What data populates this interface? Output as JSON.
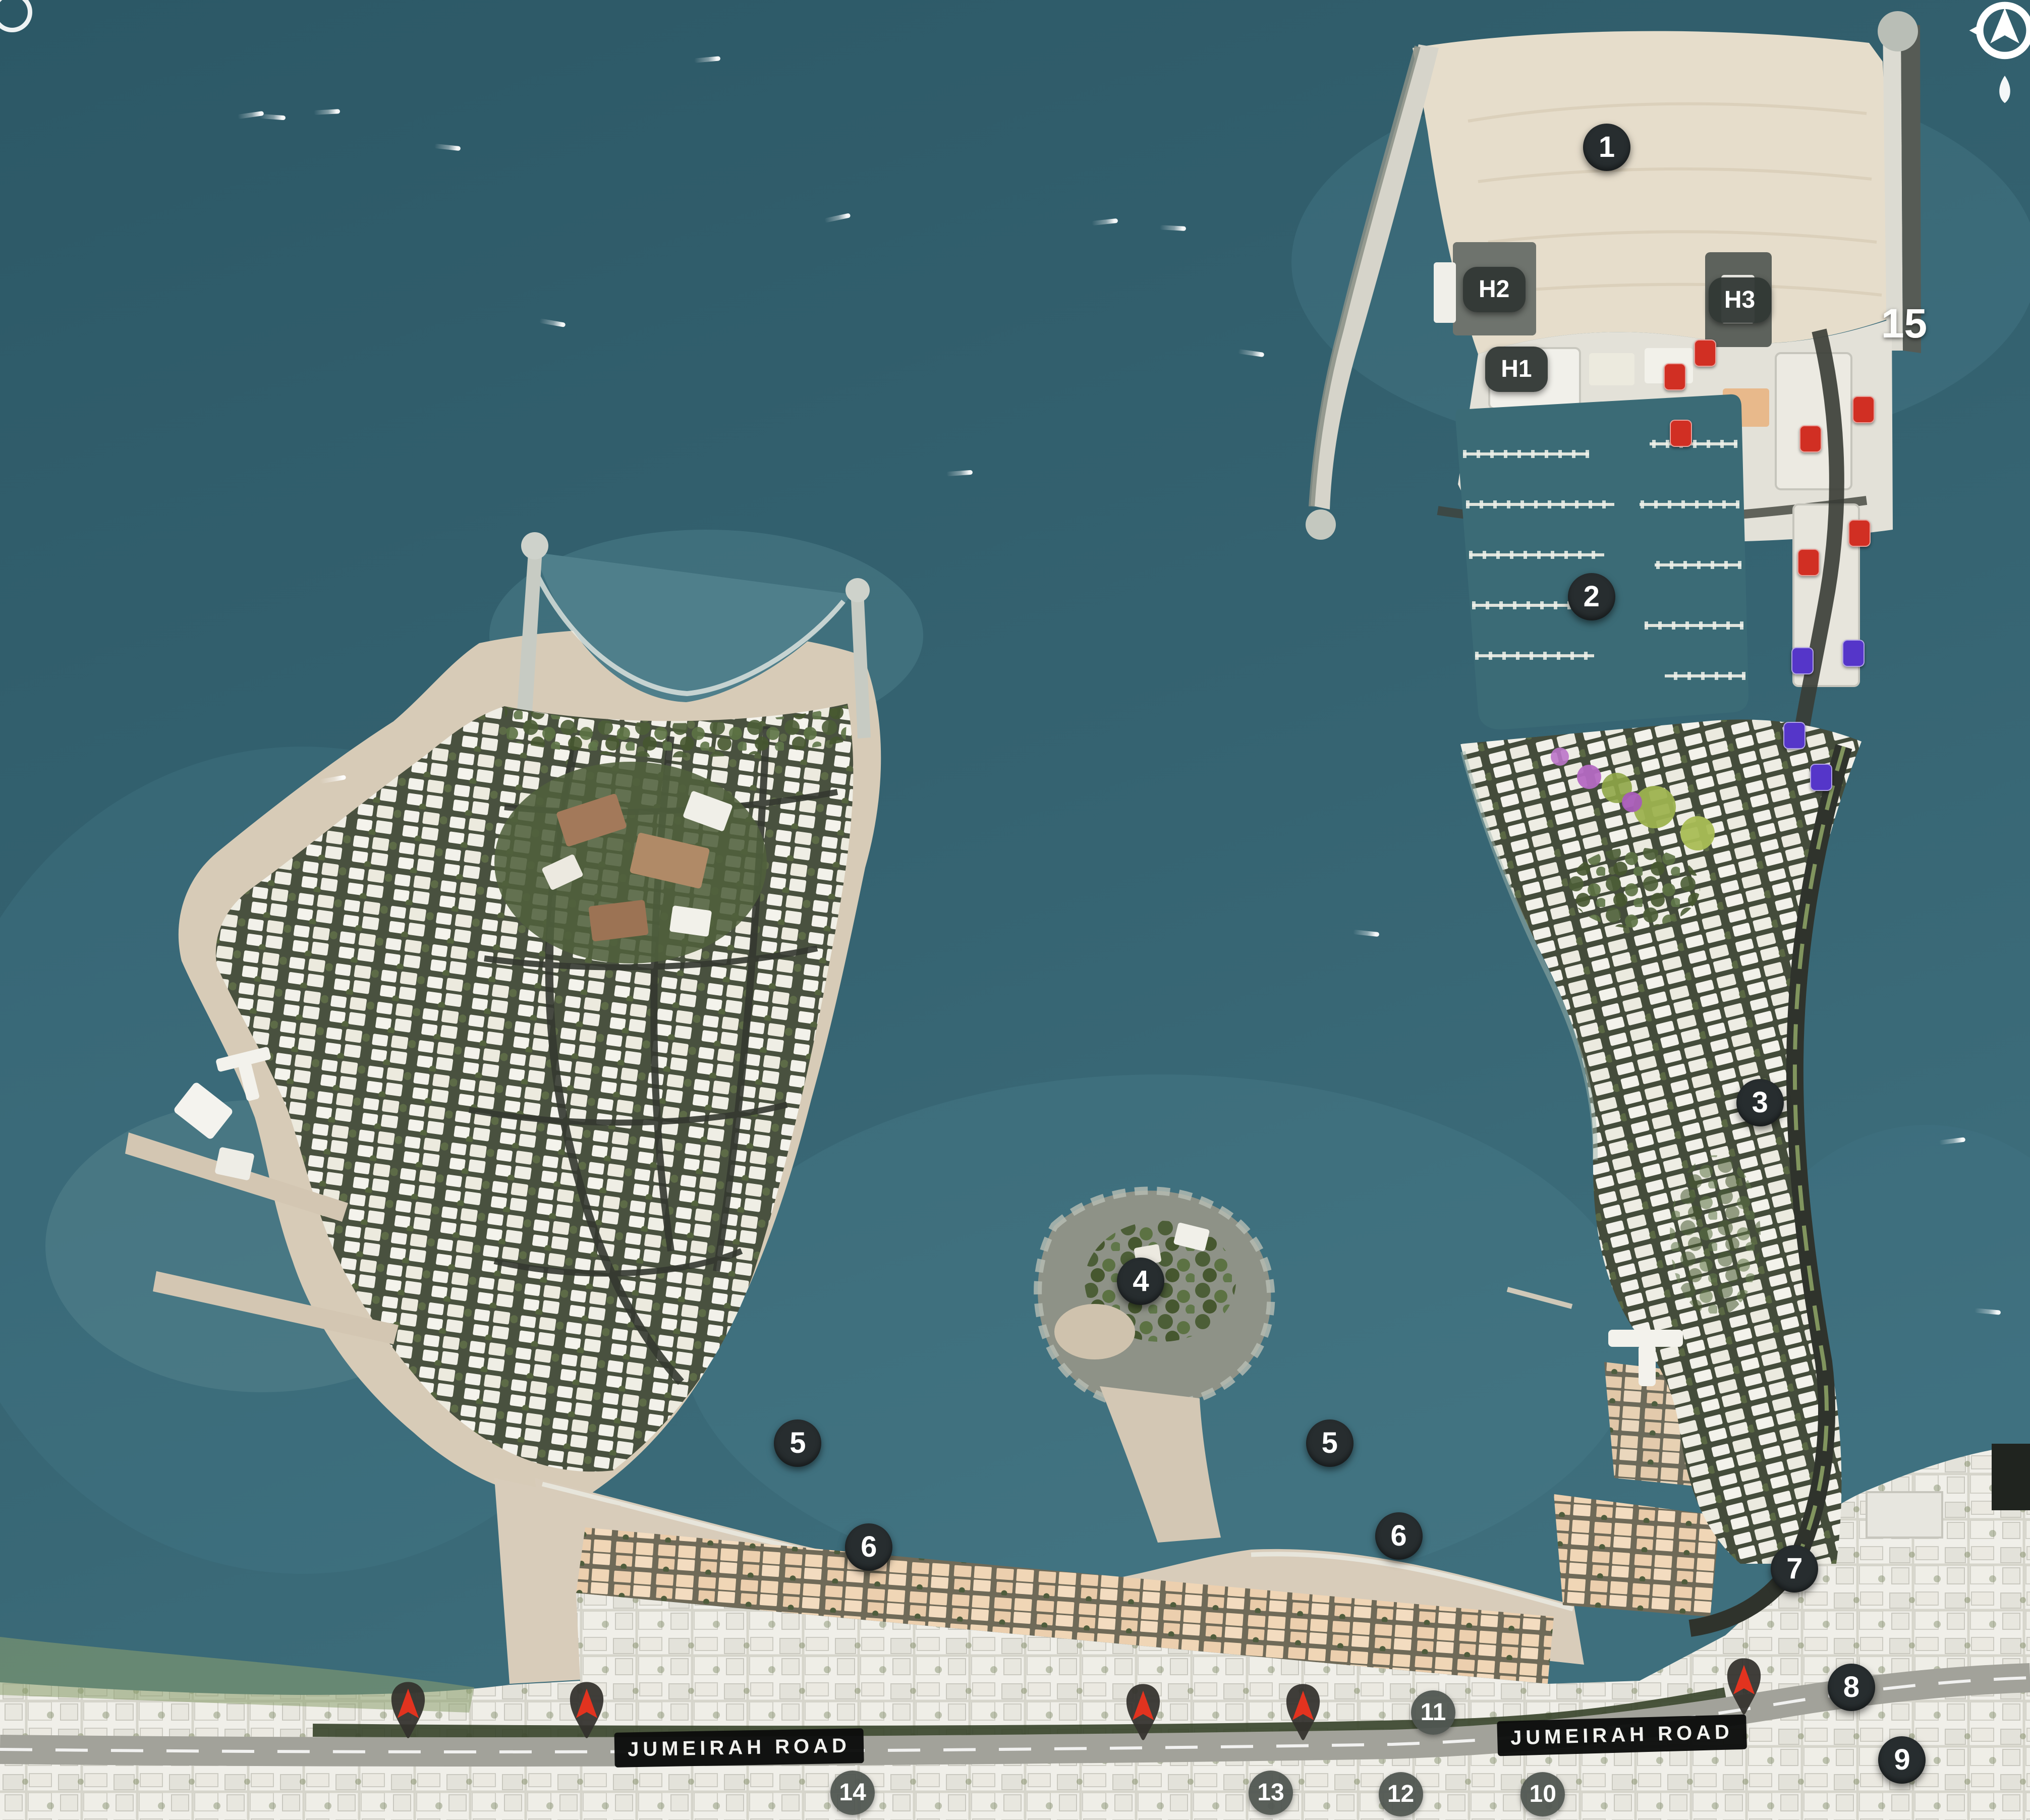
{
  "map": {
    "road_labels": [
      {
        "text": "JUMEIRAH ROAD",
        "position": "left"
      },
      {
        "text": "JUMEIRAH ROAD",
        "position": "right"
      }
    ],
    "markers": [
      {
        "label": "1",
        "x_pct": 79.15,
        "y_pct": 8.1,
        "variant": "dark"
      },
      {
        "label": "2",
        "x_pct": 78.4,
        "y_pct": 32.8,
        "variant": "dark"
      },
      {
        "label": "3",
        "x_pct": 86.7,
        "y_pct": 60.6,
        "variant": "dark"
      },
      {
        "label": "4",
        "x_pct": 56.2,
        "y_pct": 70.4,
        "variant": "dark"
      },
      {
        "label": "5",
        "x_pct": 39.3,
        "y_pct": 79.3,
        "variant": "dark"
      },
      {
        "label": "5",
        "x_pct": 65.5,
        "y_pct": 79.3,
        "variant": "dark"
      },
      {
        "label": "6",
        "x_pct": 42.8,
        "y_pct": 85.0,
        "variant": "dark"
      },
      {
        "label": "6",
        "x_pct": 68.9,
        "y_pct": 84.4,
        "variant": "dark"
      },
      {
        "label": "7",
        "x_pct": 88.4,
        "y_pct": 86.2,
        "variant": "dark"
      },
      {
        "label": "8",
        "x_pct": 91.2,
        "y_pct": 92.7,
        "variant": "dark"
      },
      {
        "label": "9",
        "x_pct": 93.7,
        "y_pct": 96.7,
        "variant": "dark"
      },
      {
        "label": "10",
        "x_pct": 76.0,
        "y_pct": 98.6,
        "variant": "grey"
      },
      {
        "label": "11",
        "x_pct": 70.6,
        "y_pct": 94.1,
        "variant": "grey"
      },
      {
        "label": "12",
        "x_pct": 69.0,
        "y_pct": 98.6,
        "variant": "grey"
      },
      {
        "label": "13",
        "x_pct": 62.6,
        "y_pct": 98.5,
        "variant": "grey"
      },
      {
        "label": "14",
        "x_pct": 42.0,
        "y_pct": 98.5,
        "variant": "grey"
      },
      {
        "label": "15",
        "x_pct": 93.8,
        "y_pct": 17.8,
        "variant": "plain"
      },
      {
        "label": "H1",
        "x_pct": 74.7,
        "y_pct": 20.3,
        "variant": "hotel"
      },
      {
        "label": "H2",
        "x_pct": 73.6,
        "y_pct": 15.9,
        "variant": "hotel"
      },
      {
        "label": "H3",
        "x_pct": 85.7,
        "y_pct": 16.5,
        "variant": "hotel"
      }
    ],
    "pins": [
      {
        "x_pct": 20.1,
        "y_pct": 94.4
      },
      {
        "x_pct": 28.9,
        "y_pct": 94.4
      },
      {
        "x_pct": 56.3,
        "y_pct": 94.5
      },
      {
        "x_pct": 64.2,
        "y_pct": 94.5
      },
      {
        "x_pct": 85.9,
        "y_pct": 93.1
      }
    ],
    "badges": [
      {
        "color": "red",
        "x_pct": 82.5,
        "y_pct": 20.7
      },
      {
        "color": "red",
        "x_pct": 82.8,
        "y_pct": 23.8
      },
      {
        "color": "red",
        "x_pct": 84.0,
        "y_pct": 19.4
      },
      {
        "color": "red",
        "x_pct": 91.8,
        "y_pct": 22.5
      },
      {
        "color": "red",
        "x_pct": 89.2,
        "y_pct": 24.1
      },
      {
        "color": "red",
        "x_pct": 91.6,
        "y_pct": 29.3
      },
      {
        "color": "red",
        "x_pct": 89.1,
        "y_pct": 30.9
      },
      {
        "color": "purple",
        "x_pct": 88.8,
        "y_pct": 36.3
      },
      {
        "color": "purple",
        "x_pct": 91.3,
        "y_pct": 35.9
      },
      {
        "color": "purple",
        "x_pct": 88.4,
        "y_pct": 40.4
      },
      {
        "color": "purple",
        "x_pct": 89.7,
        "y_pct": 42.7
      }
    ],
    "boats": [
      {
        "x_pct": 12.35,
        "y_pct": 6.32,
        "rot": -8
      },
      {
        "x_pct": 13.42,
        "y_pct": 6.43,
        "rot": 4
      },
      {
        "x_pct": 16.1,
        "y_pct": 6.15,
        "rot": -3
      },
      {
        "x_pct": 22.04,
        "y_pct": 8.09,
        "rot": 6
      },
      {
        "x_pct": 34.84,
        "y_pct": 3.27,
        "rot": -5
      },
      {
        "x_pct": 27.21,
        "y_pct": 17.74,
        "rot": 10
      },
      {
        "x_pct": 41.25,
        "y_pct": 11.97,
        "rot": -12
      },
      {
        "x_pct": 54.42,
        "y_pct": 12.2,
        "rot": -6
      },
      {
        "x_pct": 57.78,
        "y_pct": 12.53,
        "rot": 3
      },
      {
        "x_pct": 61.63,
        "y_pct": 19.4,
        "rot": 8
      },
      {
        "x_pct": 47.27,
        "y_pct": 26.0,
        "rot": -4
      },
      {
        "x_pct": 67.3,
        "y_pct": 51.28,
        "rot": 6
      },
      {
        "x_pct": 96.17,
        "y_pct": 62.69,
        "rot": -7
      },
      {
        "x_pct": 97.91,
        "y_pct": 72.06,
        "rot": 5
      },
      {
        "x_pct": 16.4,
        "y_pct": 42.82,
        "rot": -10
      }
    ]
  }
}
